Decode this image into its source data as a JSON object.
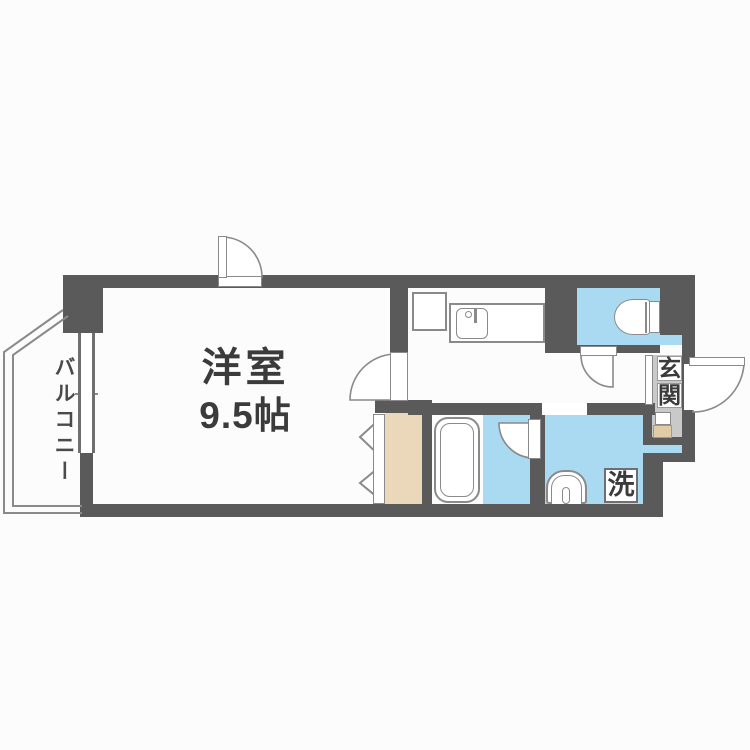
{
  "colors": {
    "bg": "#fcfcfc",
    "wall": "#5a5a5a",
    "room_blue": "#a9daf2",
    "closet_beige": "#ebd8ba",
    "genkan_gray": "#c9c9c9",
    "line_gray": "#8a8a8a",
    "text": "#3b3b3b"
  },
  "rooms": {
    "main": {
      "name": "洋室",
      "size": "9.5帖"
    },
    "balcony": {
      "name": "バルコニー"
    },
    "entrance": {
      "name": "玄関",
      "chars": [
        "玄",
        "関"
      ]
    },
    "laundry": {
      "label": "洗"
    }
  }
}
